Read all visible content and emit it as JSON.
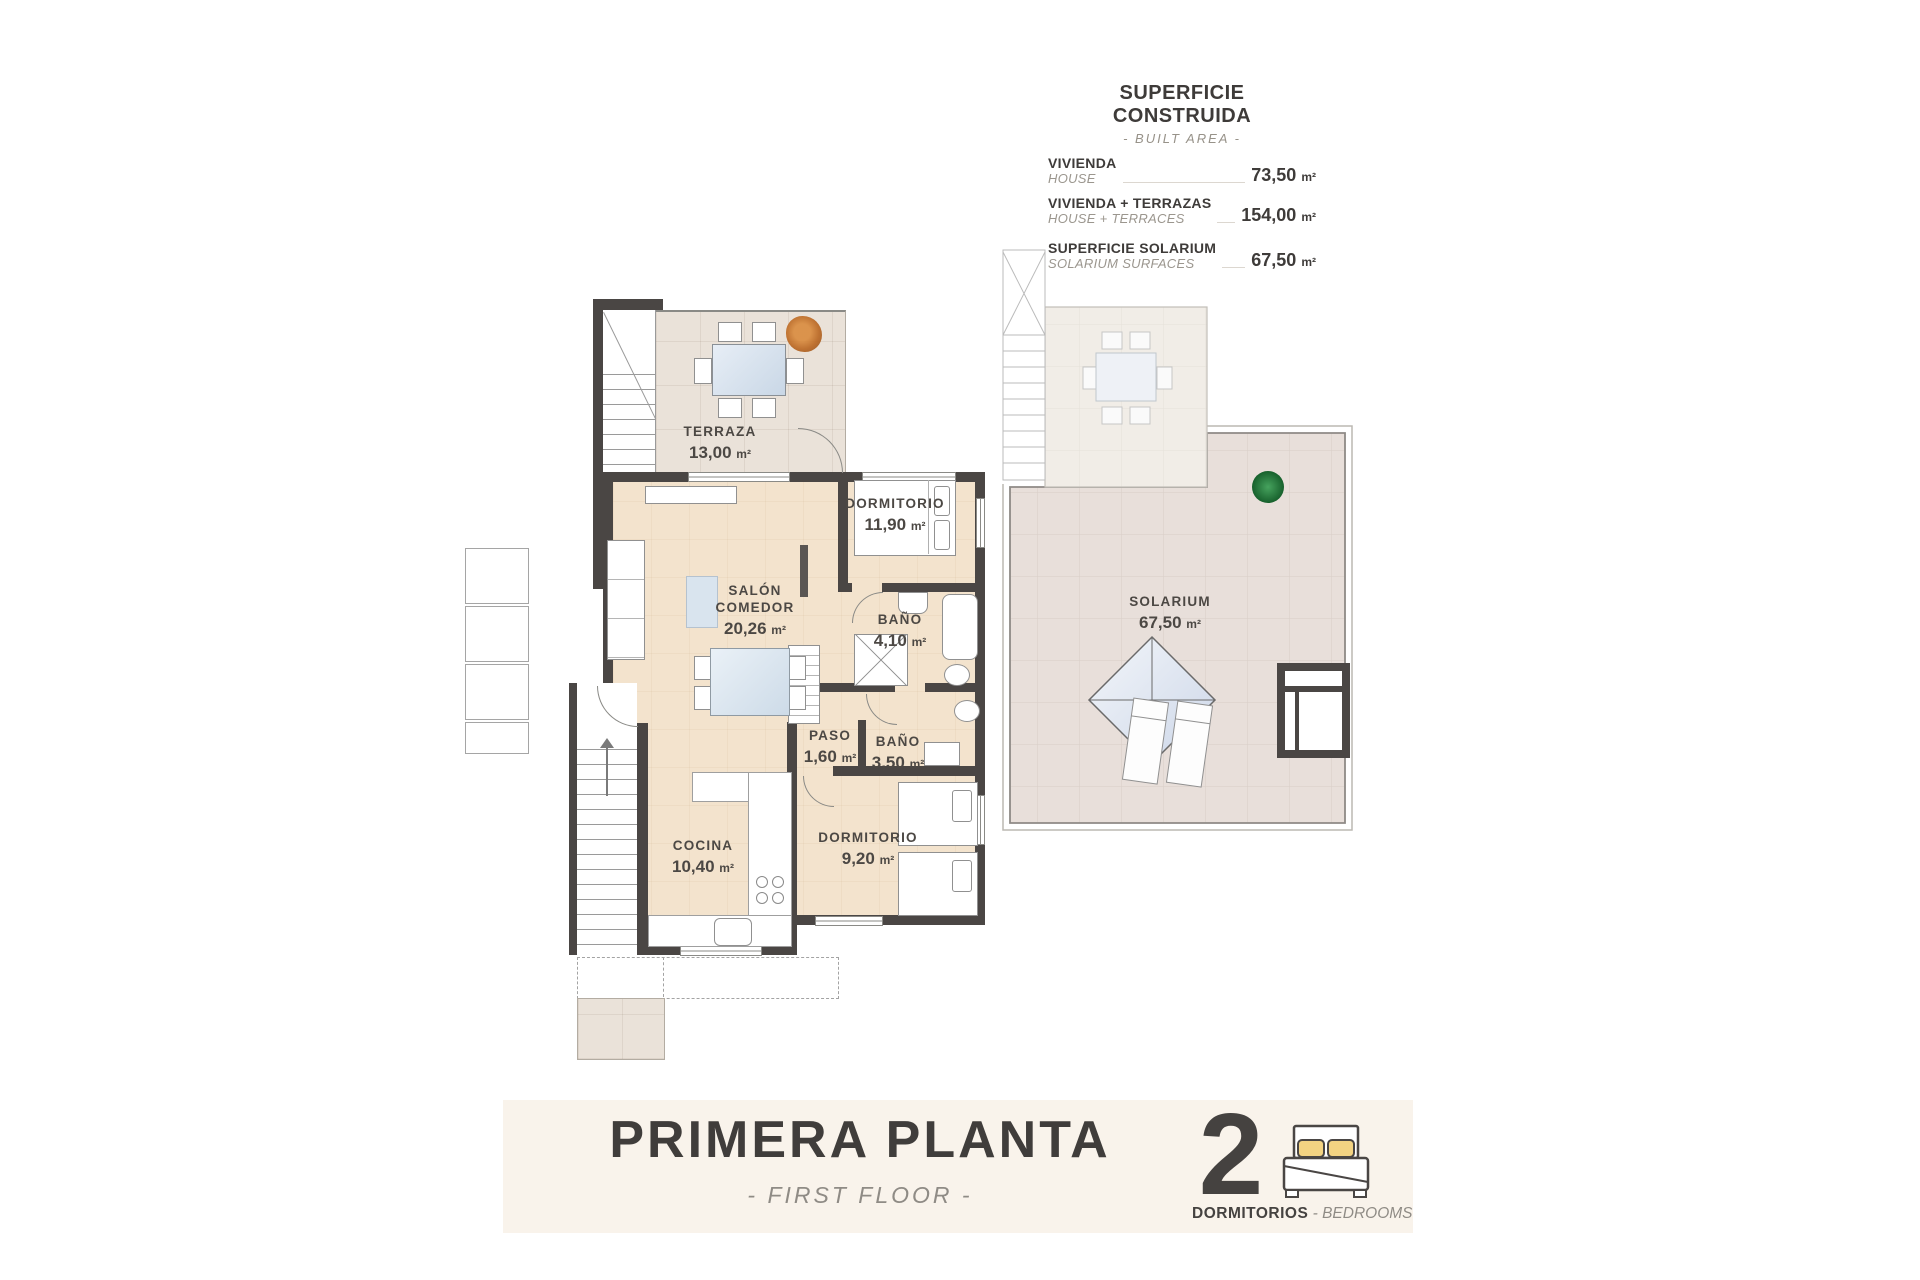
{
  "area_table": {
    "title": "SUPERFICIE CONSTRUIDA",
    "subtitle": "- BUILT AREA -",
    "rows": [
      {
        "label": "VIVIENDA",
        "label_en": "HOUSE",
        "value": "73,50",
        "unit": "m²"
      },
      {
        "label": "VIVIENDA + TERRAZAS",
        "label_en": "HOUSE + TERRACES",
        "value": "154,00",
        "unit": "m²"
      },
      {
        "label": "SUPERFICIE SOLARIUM",
        "label_en": "SOLARIUM SURFACES",
        "value": "67,50",
        "unit": "m²"
      }
    ]
  },
  "rooms": [
    {
      "name": "TERRAZA",
      "area": "13,00",
      "unit": "m²"
    },
    {
      "name": "DORMITORIO",
      "area": "11,90",
      "unit": "m²"
    },
    {
      "name": "SALÓN COMEDOR",
      "area": "20,26",
      "unit": "m²"
    },
    {
      "name": "BAÑO",
      "area": "4,10",
      "unit": "m²"
    },
    {
      "name": "PASO",
      "area": "1,60",
      "unit": "m²"
    },
    {
      "name": "BAÑO",
      "area": "3,50",
      "unit": "m²"
    },
    {
      "name": "COCINA",
      "area": "10,40",
      "unit": "m²"
    },
    {
      "name": "DORMITORIO",
      "area": "9,20",
      "unit": "m²"
    },
    {
      "name": "SOLARIUM",
      "area": "67,50",
      "unit": "m²"
    }
  ],
  "footer": {
    "title": "PRIMERA PLANTA",
    "subtitle": "- FIRST FLOOR -",
    "bedrooms_count": "2",
    "bedrooms_label": "DORMITORIOS",
    "bedrooms_separator": " - ",
    "bedrooms_label_en": "BEDROOMS"
  },
  "icons": {
    "bedrooms": "bed-icon"
  },
  "colors": {
    "wall": "#4a4644",
    "floor": "#f3e3cd",
    "terrace_tile": "#eae2d9",
    "solarium_tile": "#e8dfda",
    "banner": "#f9f3eb",
    "pillow_accent": "#f3d382",
    "text_dark": "#3e3b39",
    "text_muted": "#95908a"
  }
}
